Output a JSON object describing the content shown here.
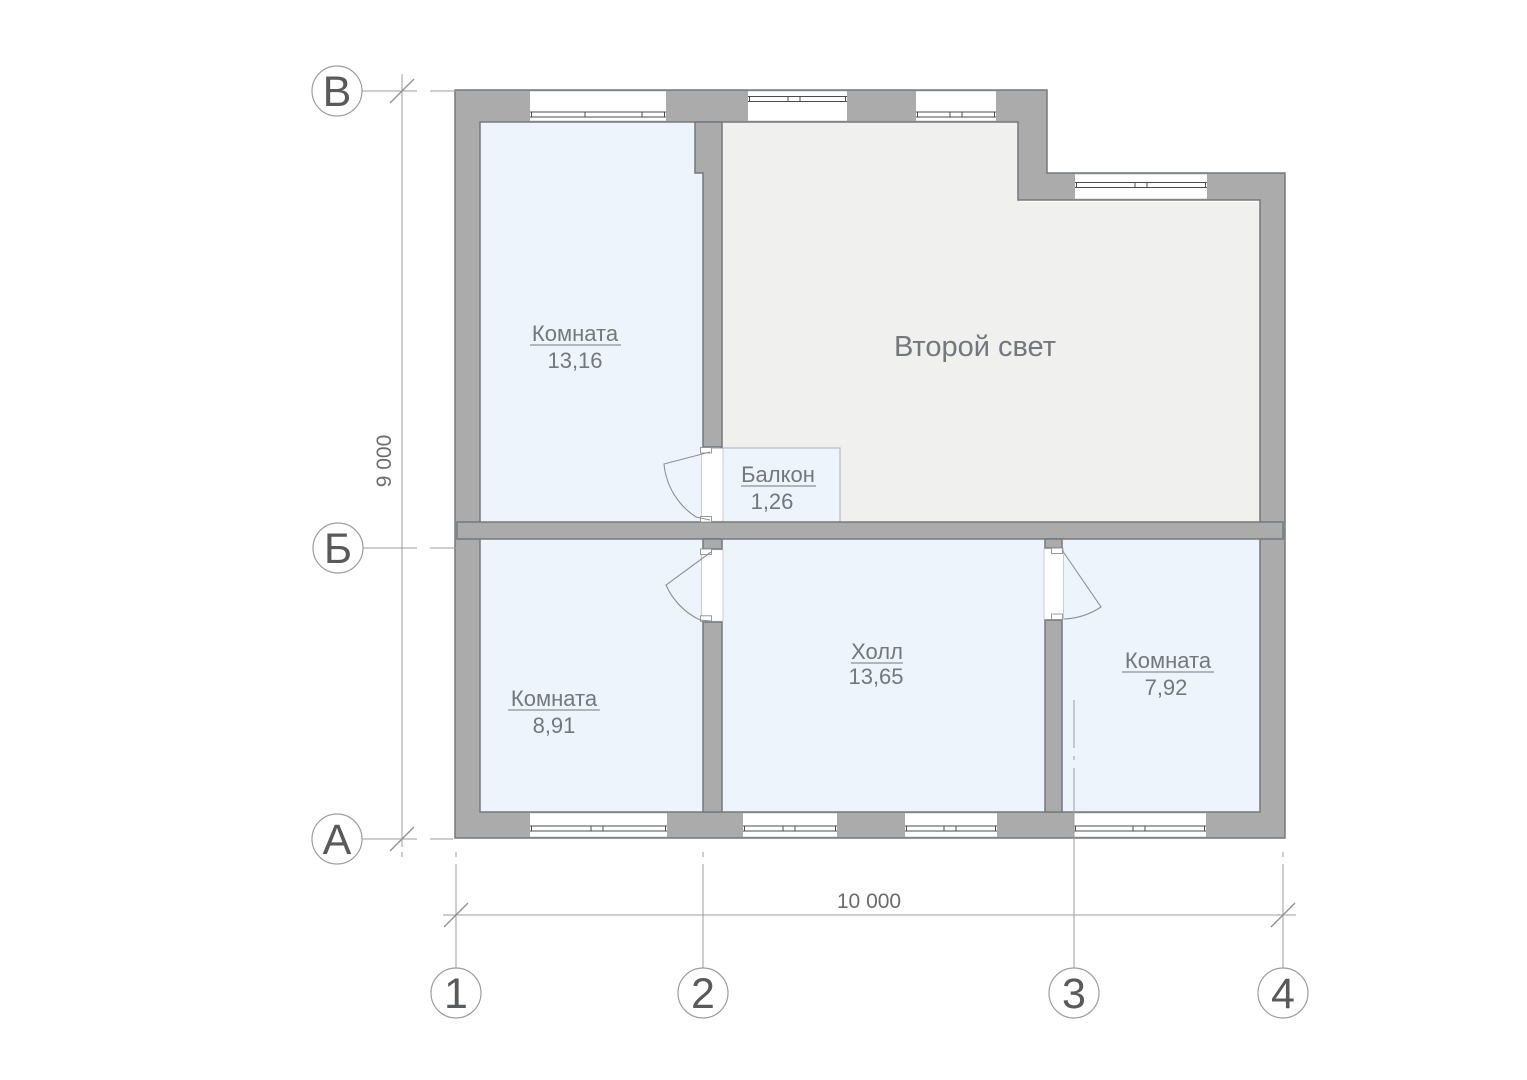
{
  "colors": {
    "wall": "#ababab",
    "wall-edge": "#75797c",
    "room-blue": "#edf4fb",
    "room-gray": "#f0f0ee",
    "balcony-edge": "#a9b1b8",
    "window-line": "#4a4c4e",
    "door-line": "#8d9196",
    "line": "#9c9ea0",
    "slash": "#8f9193",
    "axis-text": "#595a5c",
    "dim-text": "#6b6c6e",
    "label-text": "#74777b"
  },
  "dims": {
    "horizontal": "10 000",
    "vertical": "9 000"
  },
  "axis_rows": [
    {
      "label": "В"
    },
    {
      "label": "Б"
    },
    {
      "label": "А"
    }
  ],
  "axis_cols": [
    {
      "label": "1"
    },
    {
      "label": "2"
    },
    {
      "label": "3"
    },
    {
      "label": "4"
    }
  ],
  "rooms": [
    {
      "name": "Комната",
      "area": "13,16"
    },
    {
      "name": "Второй свет"
    },
    {
      "name": "Балкон",
      "area": "1,26"
    },
    {
      "name": "Комната",
      "area": "8,91"
    },
    {
      "name": "Холл",
      "area": "13,65"
    },
    {
      "name": "Комната",
      "area": "7,92"
    }
  ]
}
